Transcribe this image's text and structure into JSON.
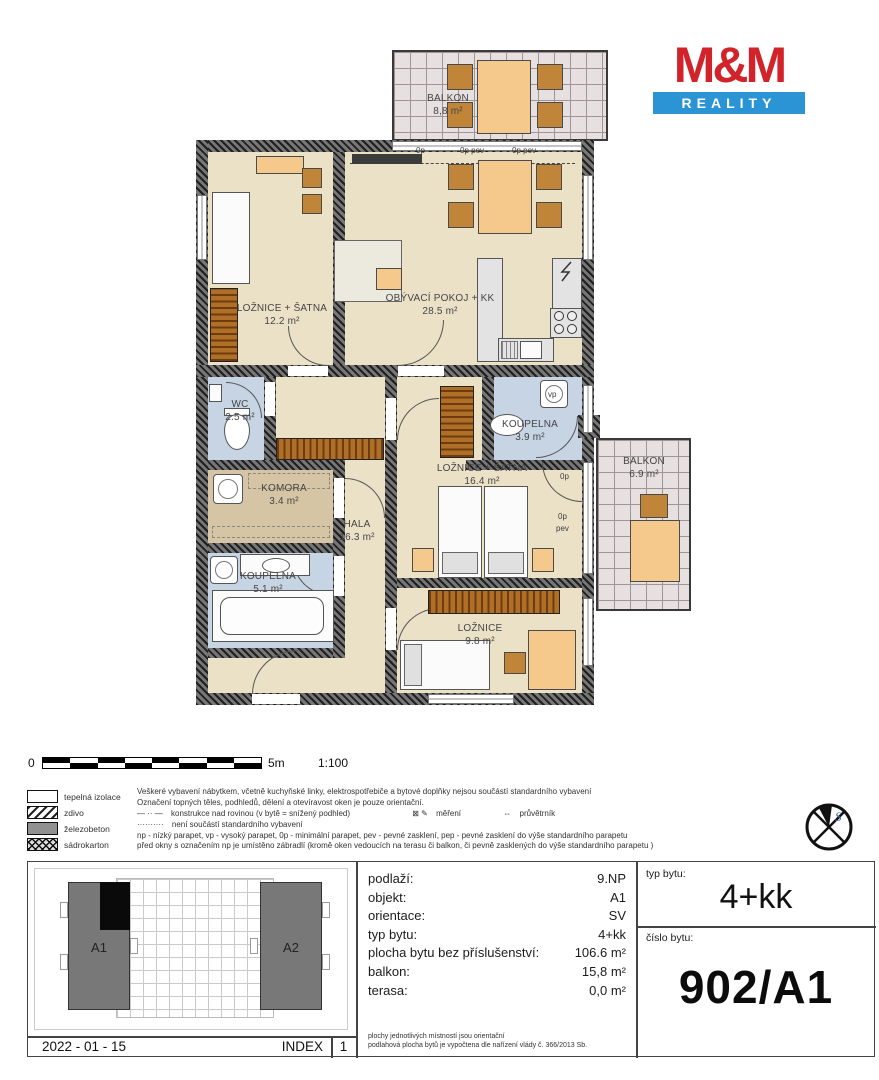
{
  "logo": {
    "mm": "M&M",
    "reality": "REALITY"
  },
  "plan": {
    "balconies": [
      {
        "name": "BALKON",
        "area": "8,8 m²"
      },
      {
        "name": "BALKON",
        "area": "6.9 m²"
      }
    ],
    "rooms": [
      {
        "name": "LOŽNICE + ŠATNA",
        "area": "12.2 m²"
      },
      {
        "name": "OBÝVACÍ POKOJ + KK",
        "area": "28.5 m²"
      },
      {
        "name": "WC",
        "area": "2.5 m²"
      },
      {
        "name": "KOUPELNA",
        "area": "3.9 m²"
      },
      {
        "name": "LOŽNICE + ŠATNA",
        "area": "16.4 m²"
      },
      {
        "name": "KOMORA",
        "area": "3.4 m²"
      },
      {
        "name": "HALA",
        "area": "16.3 m²"
      },
      {
        "name": "KOUPELNA",
        "area": "5.1 m²"
      },
      {
        "name": "LOŽNICE",
        "area": "9.8 m²"
      }
    ],
    "window_labels": {
      "top1": "0p",
      "top2": "0p pev",
      "top3": "0p pev",
      "vp": "vp",
      "right1": "0p",
      "right2a": "0p",
      "right2b": "pev"
    }
  },
  "scalebar": {
    "zero": "0",
    "end": "5m",
    "ratio": "1:100"
  },
  "legend": {
    "items": [
      {
        "label": "tepelná izolace"
      },
      {
        "label": "zdivo"
      },
      {
        "label": "železobeton"
      },
      {
        "label": "sádrokarton"
      }
    ],
    "line1": "Veškeré vybavení nábytkem, včetně kuchyňské linky, elektrospotřebiče a bytové doplňky nejsou součástí standardního vybavení",
    "line2": "Označení topných těles, podhledů, dělení a otevíravost oken je pouze orientační.",
    "dashdot_symbol": "— ·· —",
    "line3a": "konstrukce nad rovinou (v bytě = snížený podhled)",
    "mereni_icon": "⊠ ✎",
    "line3b": "měření",
    "pruvetrnik_icon": "⇔",
    "line3c": "průvětrník",
    "dotted_symbol": "··········",
    "line4": "není součástí standardního vybavení",
    "line5": "np - nízký parapet, vp - vysoký parapet, 0p - minimální parapet, pev - pevné zasklení,  pep - pevné zasklení do výše standardního parapetu",
    "line6": "před okny s označením np je umístěno zábradlí (kromě oken vedoucích na terasu či balkon, či pevně zasklených do výše standardního parapetu )"
  },
  "compass": {
    "letter": "S"
  },
  "info": {
    "rows": [
      {
        "label": "podlaží:",
        "value": "9.NP"
      },
      {
        "label": "objekt:",
        "value": "A1"
      },
      {
        "label": "orientace:",
        "value": "SV"
      },
      {
        "label": "typ bytu:",
        "value": "4+kk"
      },
      {
        "label": "plocha bytu bez příslušenství:",
        "value": "106.6 m²"
      },
      {
        "label": "balkon:",
        "value": "15,8 m²"
      },
      {
        "label": "terasa:",
        "value": "0,0 m²"
      }
    ],
    "note1": "plochy jednotlivých místností jsou orientační",
    "note2": "podlahová plocha bytů je vypočtena dle nařízení vlády č. 366/2013 Sb.",
    "typ_label": "typ bytu:",
    "typ_value": "4+kk",
    "cislo_label": "číslo bytu:",
    "cislo_value": "902/A1"
  },
  "siteplan": {
    "a1": "A1",
    "a2": "A2",
    "date": "2022 - 01 - 15",
    "index_label": "INDEX",
    "index_value": "1"
  }
}
